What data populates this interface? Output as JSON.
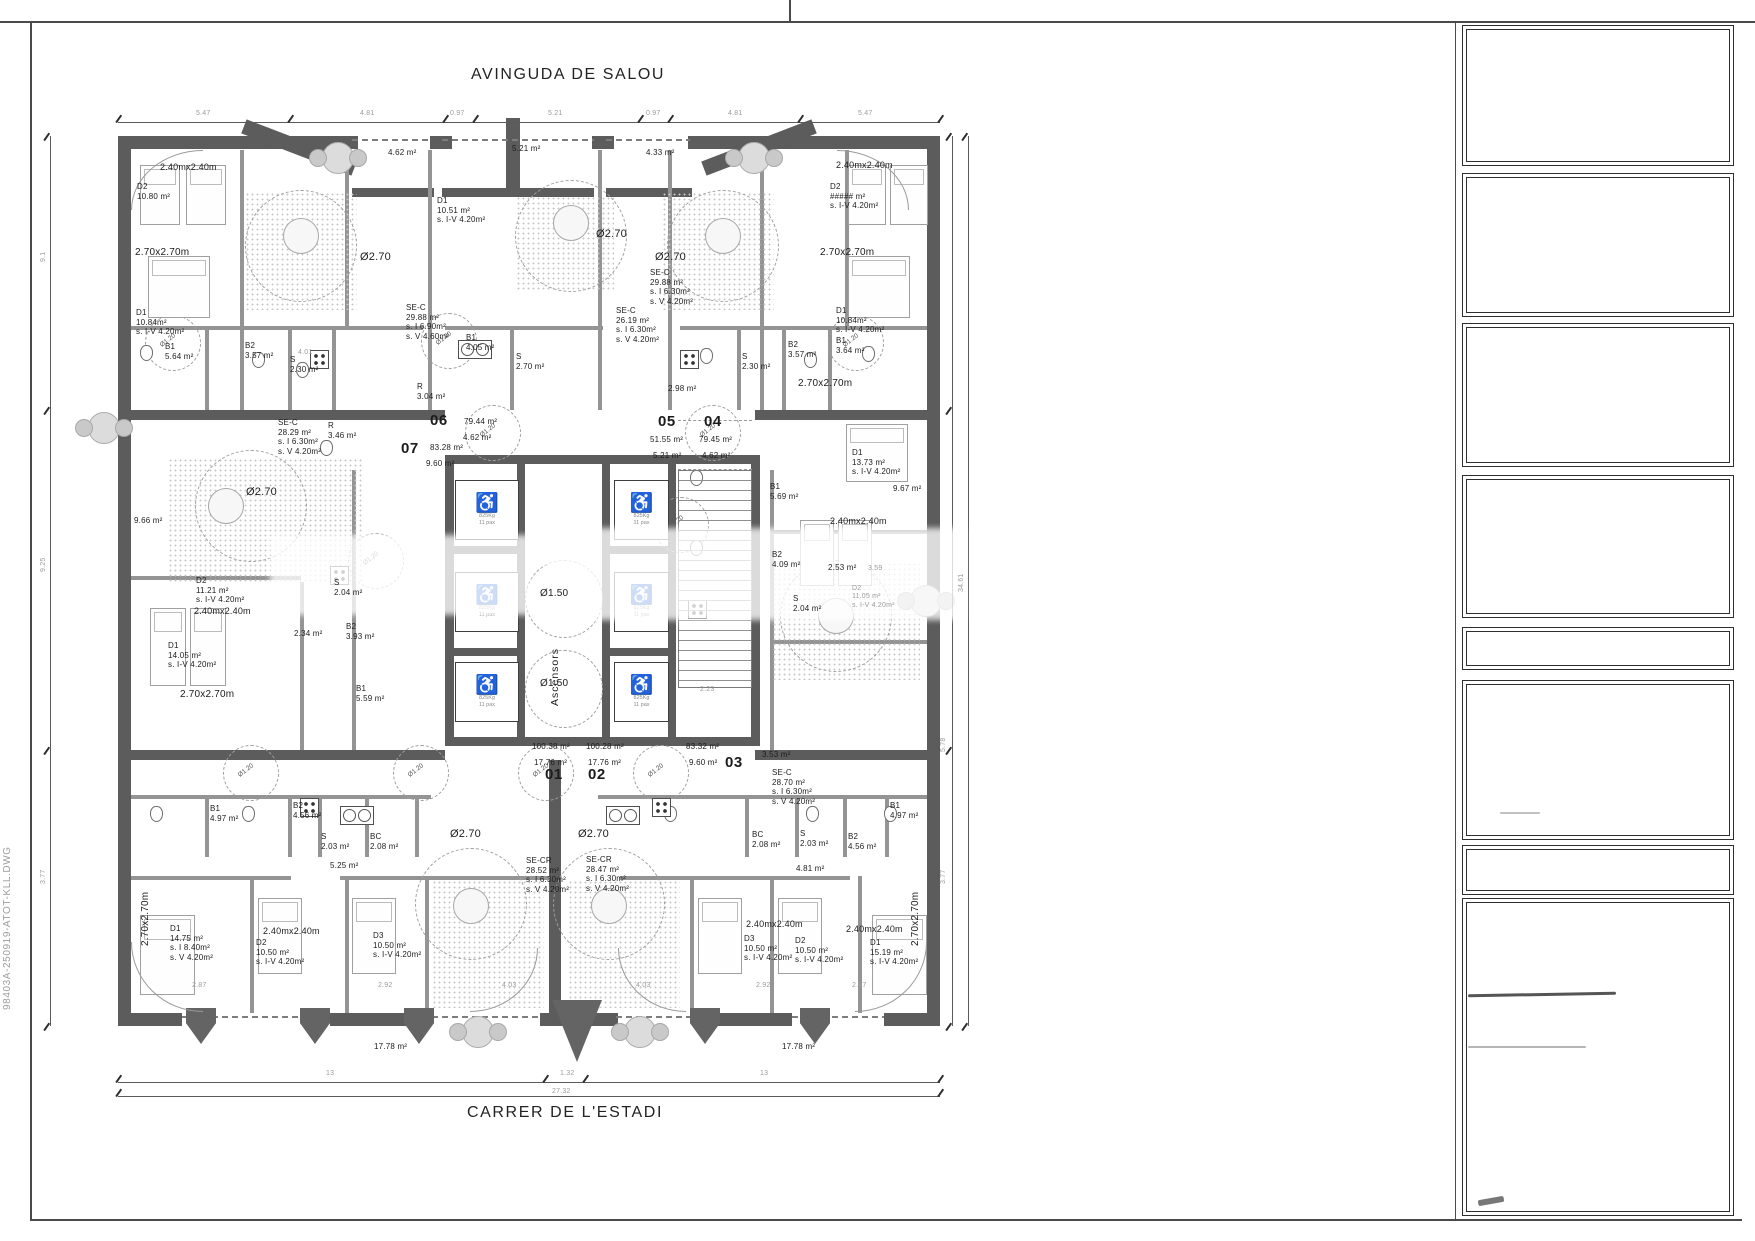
{
  "streets": {
    "top": "AVINGUDA DE SALOU",
    "bottom": "CARRER DE L'ESTADI"
  },
  "filename": "98403A-250919-ATOT-KLL.DWG",
  "core": {
    "ascensors": "Ascensors",
    "o120": "Ø1.20",
    "wheelchair": "♿",
    "cabin": "825Kg\n11 pax"
  },
  "plan_labels": [
    {
      "t": "4.62 m²",
      "x": 388,
      "y": 148
    },
    {
      "t": "5.21 m²",
      "x": 512,
      "y": 144
    },
    {
      "t": "4.33 m²",
      "x": 646,
      "y": 148
    },
    {
      "t": "2.40mx2.40m",
      "x": 160,
      "y": 162,
      "fs": 9
    },
    {
      "t": "D2\n10.80 m²",
      "x": 137,
      "y": 182
    },
    {
      "t": "2.70x2.70m",
      "x": 135,
      "y": 247,
      "fs": 10
    },
    {
      "t": "D1\n10.84m²\ns. I-V  4.20m²",
      "x": 136,
      "y": 308
    },
    {
      "t": "B1\n5.64 m²",
      "x": 165,
      "y": 342
    },
    {
      "t": "B2\n3.57 m²",
      "x": 245,
      "y": 341
    },
    {
      "t": "S\n2.30 m²",
      "x": 290,
      "y": 355
    },
    {
      "t": "SE-C\n29.88 m²\ns. I  6.90m²\ns. V 4.60m²",
      "x": 406,
      "y": 303
    },
    {
      "t": "R\n3.04 m²",
      "x": 417,
      "y": 382
    },
    {
      "t": "Ø2.70",
      "x": 360,
      "y": 251,
      "fs": 11
    },
    {
      "t": "D1\n10.51 m²\ns. I-V  4.20m²",
      "x": 437,
      "y": 196
    },
    {
      "t": "B1\n4.05 m²",
      "x": 466,
      "y": 333
    },
    {
      "t": "S\n2.70 m²",
      "x": 516,
      "y": 352
    },
    {
      "t": "SE-C\n26.19 m²\ns. I  6.30m²\ns. V 4.20m²",
      "x": 616,
      "y": 306
    },
    {
      "t": "SE-C\n29.88 m²\ns. I  6.30m²\ns. V 4.20m²",
      "x": 650,
      "y": 268
    },
    {
      "t": "2.98 m²",
      "x": 668,
      "y": 384
    },
    {
      "t": "Ø2.70",
      "x": 596,
      "y": 228,
      "fs": 11
    },
    {
      "t": "Ø2.70",
      "x": 655,
      "y": 251,
      "fs": 11
    },
    {
      "t": "2.40mx2.40m",
      "x": 836,
      "y": 160,
      "fs": 9
    },
    {
      "t": "D2\n##### m²\ns. I-V  4.20m²",
      "x": 830,
      "y": 182
    },
    {
      "t": "2.70x2.70m",
      "x": 820,
      "y": 247,
      "fs": 10
    },
    {
      "t": "D1\n10.84m²\ns. I-V  4.20m²",
      "x": 836,
      "y": 306
    },
    {
      "t": "S\n2.30 m²",
      "x": 742,
      "y": 352
    },
    {
      "t": "B2\n3.57 m²",
      "x": 788,
      "y": 340
    },
    {
      "t": "B1\n3.64 m²",
      "x": 836,
      "y": 336
    },
    {
      "t": "SE-C\n28.29 m²\ns. I  6.30m²\ns. V 4.20m²",
      "x": 278,
      "y": 418
    },
    {
      "t": "R\n3.46 m²",
      "x": 328,
      "y": 421
    },
    {
      "t": "9.66 m²",
      "x": 134,
      "y": 516
    },
    {
      "t": "Ø2.70",
      "x": 246,
      "y": 486,
      "fs": 11
    },
    {
      "t": "D2\n11.21 m²\ns. I-V  4.20m²",
      "x": 196,
      "y": 576
    },
    {
      "t": "2.40mx2.40m",
      "x": 194,
      "y": 606,
      "fs": 9
    },
    {
      "t": "2.34 m²",
      "x": 294,
      "y": 629
    },
    {
      "t": "S\n2.04 m²",
      "x": 334,
      "y": 578
    },
    {
      "t": "B2\n3.93 m²",
      "x": 346,
      "y": 622
    },
    {
      "t": "B1\n5.59 m²",
      "x": 356,
      "y": 684
    },
    {
      "t": "D1\n14.05 m²\ns. I-V  4.20m²",
      "x": 168,
      "y": 641
    },
    {
      "t": "2.70x2.70m",
      "x": 180,
      "y": 689,
      "fs": 10
    },
    {
      "t": "2.70x2.70m",
      "x": 798,
      "y": 378,
      "fs": 10
    },
    {
      "t": "D1\n13.73 m²\ns. I-V  4.20m²",
      "x": 852,
      "y": 448
    },
    {
      "t": "B1\n5.69 m²",
      "x": 770,
      "y": 482
    },
    {
      "t": "B2\n4.09 m²",
      "x": 772,
      "y": 550
    },
    {
      "t": "S\n2.04 m²",
      "x": 793,
      "y": 594
    },
    {
      "t": "2.53 m²",
      "x": 828,
      "y": 563
    },
    {
      "t": "2.40mx2.40m",
      "x": 830,
      "y": 516,
      "fs": 9
    },
    {
      "t": "D2\n11.05 m²\ns. I-V  4.20m²",
      "x": 852,
      "y": 585,
      "f": 1
    },
    {
      "t": "9.67 m²",
      "x": 893,
      "y": 484
    },
    {
      "t": "SE-C\n28.70 m²\ns. I  6.30m²\ns. V 4.20m²",
      "x": 772,
      "y": 768
    },
    {
      "t": "3.53 m²",
      "x": 762,
      "y": 750
    },
    {
      "t": "B1\n4.97 m²",
      "x": 210,
      "y": 804
    },
    {
      "t": "B2\n4.56 m²",
      "x": 293,
      "y": 801
    },
    {
      "t": "S\n2.03 m²",
      "x": 321,
      "y": 832
    },
    {
      "t": "BC\n2.08 m²",
      "x": 370,
      "y": 832
    },
    {
      "t": "5.25 m²",
      "x": 330,
      "y": 861
    },
    {
      "t": "SE-CR\n28.52 m²\ns. I  6.30m²\ns. V 4.20m²",
      "x": 526,
      "y": 856
    },
    {
      "t": "SE-CR\n28.47 m²\ns. I  6.30m²\ns. V 4.20m²",
      "x": 586,
      "y": 855
    },
    {
      "t": "BC\n2.08 m²",
      "x": 752,
      "y": 830
    },
    {
      "t": "S\n2.03 m²",
      "x": 800,
      "y": 829
    },
    {
      "t": "B2\n4.56 m²",
      "x": 848,
      "y": 832
    },
    {
      "t": "B1\n4.97 m²",
      "x": 890,
      "y": 801
    },
    {
      "t": "4.81 m²",
      "x": 796,
      "y": 864
    },
    {
      "t": "D1\n14.75 m²\ns. I  8.40m²\ns. V 4.20m²",
      "x": 170,
      "y": 924
    },
    {
      "t": "2.40mx2.40m",
      "x": 263,
      "y": 926,
      "fs": 9
    },
    {
      "t": "D2\n10.50 m²\ns. I-V  4.20m²",
      "x": 256,
      "y": 938
    },
    {
      "t": "D3\n10.50 m²\ns. I-V  4.20m²",
      "x": 373,
      "y": 931
    },
    {
      "t": "2.70x2.70m",
      "x": 140,
      "y": 946,
      "rot": -90,
      "fs": 10
    },
    {
      "t": "Ø2.70",
      "x": 450,
      "y": 828,
      "fs": 11
    },
    {
      "t": "Ø2.70",
      "x": 578,
      "y": 828,
      "fs": 11
    },
    {
      "t": "2.40mx2.40m",
      "x": 746,
      "y": 919,
      "fs": 9
    },
    {
      "t": "D3\n10.50 m²\ns. I-V  4.20m²",
      "x": 744,
      "y": 934
    },
    {
      "t": "2.40mx2.40m",
      "x": 846,
      "y": 924,
      "fs": 9
    },
    {
      "t": "D2\n10.50 m²\ns. I-V  4.20m²",
      "x": 795,
      "y": 936
    },
    {
      "t": "D1\n15.19 m²\ns. I-V  4.20m²",
      "x": 870,
      "y": 938
    },
    {
      "t": "2.70x2.70m",
      "x": 910,
      "y": 946,
      "rot": -90,
      "fs": 10
    },
    {
      "t": "17.78 m²",
      "x": 374,
      "y": 1042
    },
    {
      "t": "17.78 m²",
      "x": 782,
      "y": 1042
    },
    {
      "t": "2.87",
      "x": 192,
      "y": 982,
      "f": 1
    },
    {
      "t": "2.92",
      "x": 378,
      "y": 982,
      "f": 1
    },
    {
      "t": "4.03",
      "x": 502,
      "y": 982,
      "f": 1
    },
    {
      "t": "4.03",
      "x": 636,
      "y": 982,
      "f": 1
    },
    {
      "t": "2.92",
      "x": 756,
      "y": 982,
      "f": 1
    },
    {
      "t": "2.87",
      "x": 852,
      "y": 982,
      "f": 1
    },
    {
      "t": "06",
      "x": 430,
      "y": 412,
      "b": 1
    },
    {
      "t": "79.44 m²",
      "x": 464,
      "y": 417
    },
    {
      "t": "4.62 m²",
      "x": 463,
      "y": 433
    },
    {
      "t": "07",
      "x": 401,
      "y": 440,
      "b": 1
    },
    {
      "t": "83.28 m²",
      "x": 430,
      "y": 443
    },
    {
      "t": "9.60 m²",
      "x": 426,
      "y": 459
    },
    {
      "t": "05",
      "x": 658,
      "y": 413,
      "b": 1
    },
    {
      "t": "51.55 m²",
      "x": 650,
      "y": 435
    },
    {
      "t": "5.21 m²",
      "x": 653,
      "y": 451
    },
    {
      "t": "04",
      "x": 704,
      "y": 413,
      "b": 1
    },
    {
      "t": "79.45 m²",
      "x": 699,
      "y": 435
    },
    {
      "t": "4.62 m²",
      "x": 702,
      "y": 451
    },
    {
      "t": "01",
      "x": 545,
      "y": 766,
      "b": 1
    },
    {
      "t": "100.38 m²",
      "x": 532,
      "y": 742
    },
    {
      "t": "17.76 m²",
      "x": 534,
      "y": 758
    },
    {
      "t": "02",
      "x": 588,
      "y": 766,
      "b": 1
    },
    {
      "t": "100.28 m²",
      "x": 586,
      "y": 742
    },
    {
      "t": "17.76 m²",
      "x": 588,
      "y": 758
    },
    {
      "t": "03",
      "x": 725,
      "y": 754,
      "b": 1
    },
    {
      "t": "83.32 m²",
      "x": 686,
      "y": 742
    },
    {
      "t": "9.60 m²",
      "x": 689,
      "y": 758
    },
    {
      "t": "Ø1.50",
      "x": 540,
      "y": 588,
      "fs": 10
    },
    {
      "t": "Ø1.50",
      "x": 540,
      "y": 678,
      "fs": 10
    },
    {
      "t": "5.47",
      "x": 196,
      "y": 110,
      "f": 1
    },
    {
      "t": "4.81",
      "x": 360,
      "y": 110,
      "f": 1
    },
    {
      "t": "0.97",
      "x": 450,
      "y": 110,
      "f": 1
    },
    {
      "t": "5.21",
      "x": 548,
      "y": 110,
      "f": 1
    },
    {
      "t": "0.97",
      "x": 646,
      "y": 110,
      "f": 1
    },
    {
      "t": "4.81",
      "x": 728,
      "y": 110,
      "f": 1
    },
    {
      "t": "5.47",
      "x": 858,
      "y": 110,
      "f": 1
    },
    {
      "t": "13",
      "x": 326,
      "y": 1070,
      "f": 1
    },
    {
      "t": "1.32",
      "x": 560,
      "y": 1070,
      "f": 1
    },
    {
      "t": "13",
      "x": 760,
      "y": 1070,
      "f": 1
    },
    {
      "t": "27.32",
      "x": 552,
      "y": 1088,
      "f": 1
    },
    {
      "t": "9.1",
      "x": 40,
      "y": 262,
      "rot": -90,
      "f": 1
    },
    {
      "t": "9.25",
      "x": 40,
      "y": 572,
      "rot": -90,
      "f": 1
    },
    {
      "t": "3.77",
      "x": 40,
      "y": 884,
      "rot": -90,
      "f": 1
    },
    {
      "t": "5.78",
      "x": 940,
      "y": 752,
      "rot": -90,
      "f": 1
    },
    {
      "t": "3.77",
      "x": 940,
      "y": 884,
      "rot": -90,
      "f": 1
    },
    {
      "t": "34.61",
      "x": 958,
      "y": 592,
      "rot": -90,
      "f": 1
    },
    {
      "t": "4.01",
      "x": 298,
      "y": 349,
      "f": 1
    },
    {
      "t": "2.23",
      "x": 700,
      "y": 686,
      "f": 1
    },
    {
      "t": "3.59",
      "x": 868,
      "y": 565,
      "f": 1
    }
  ]
}
